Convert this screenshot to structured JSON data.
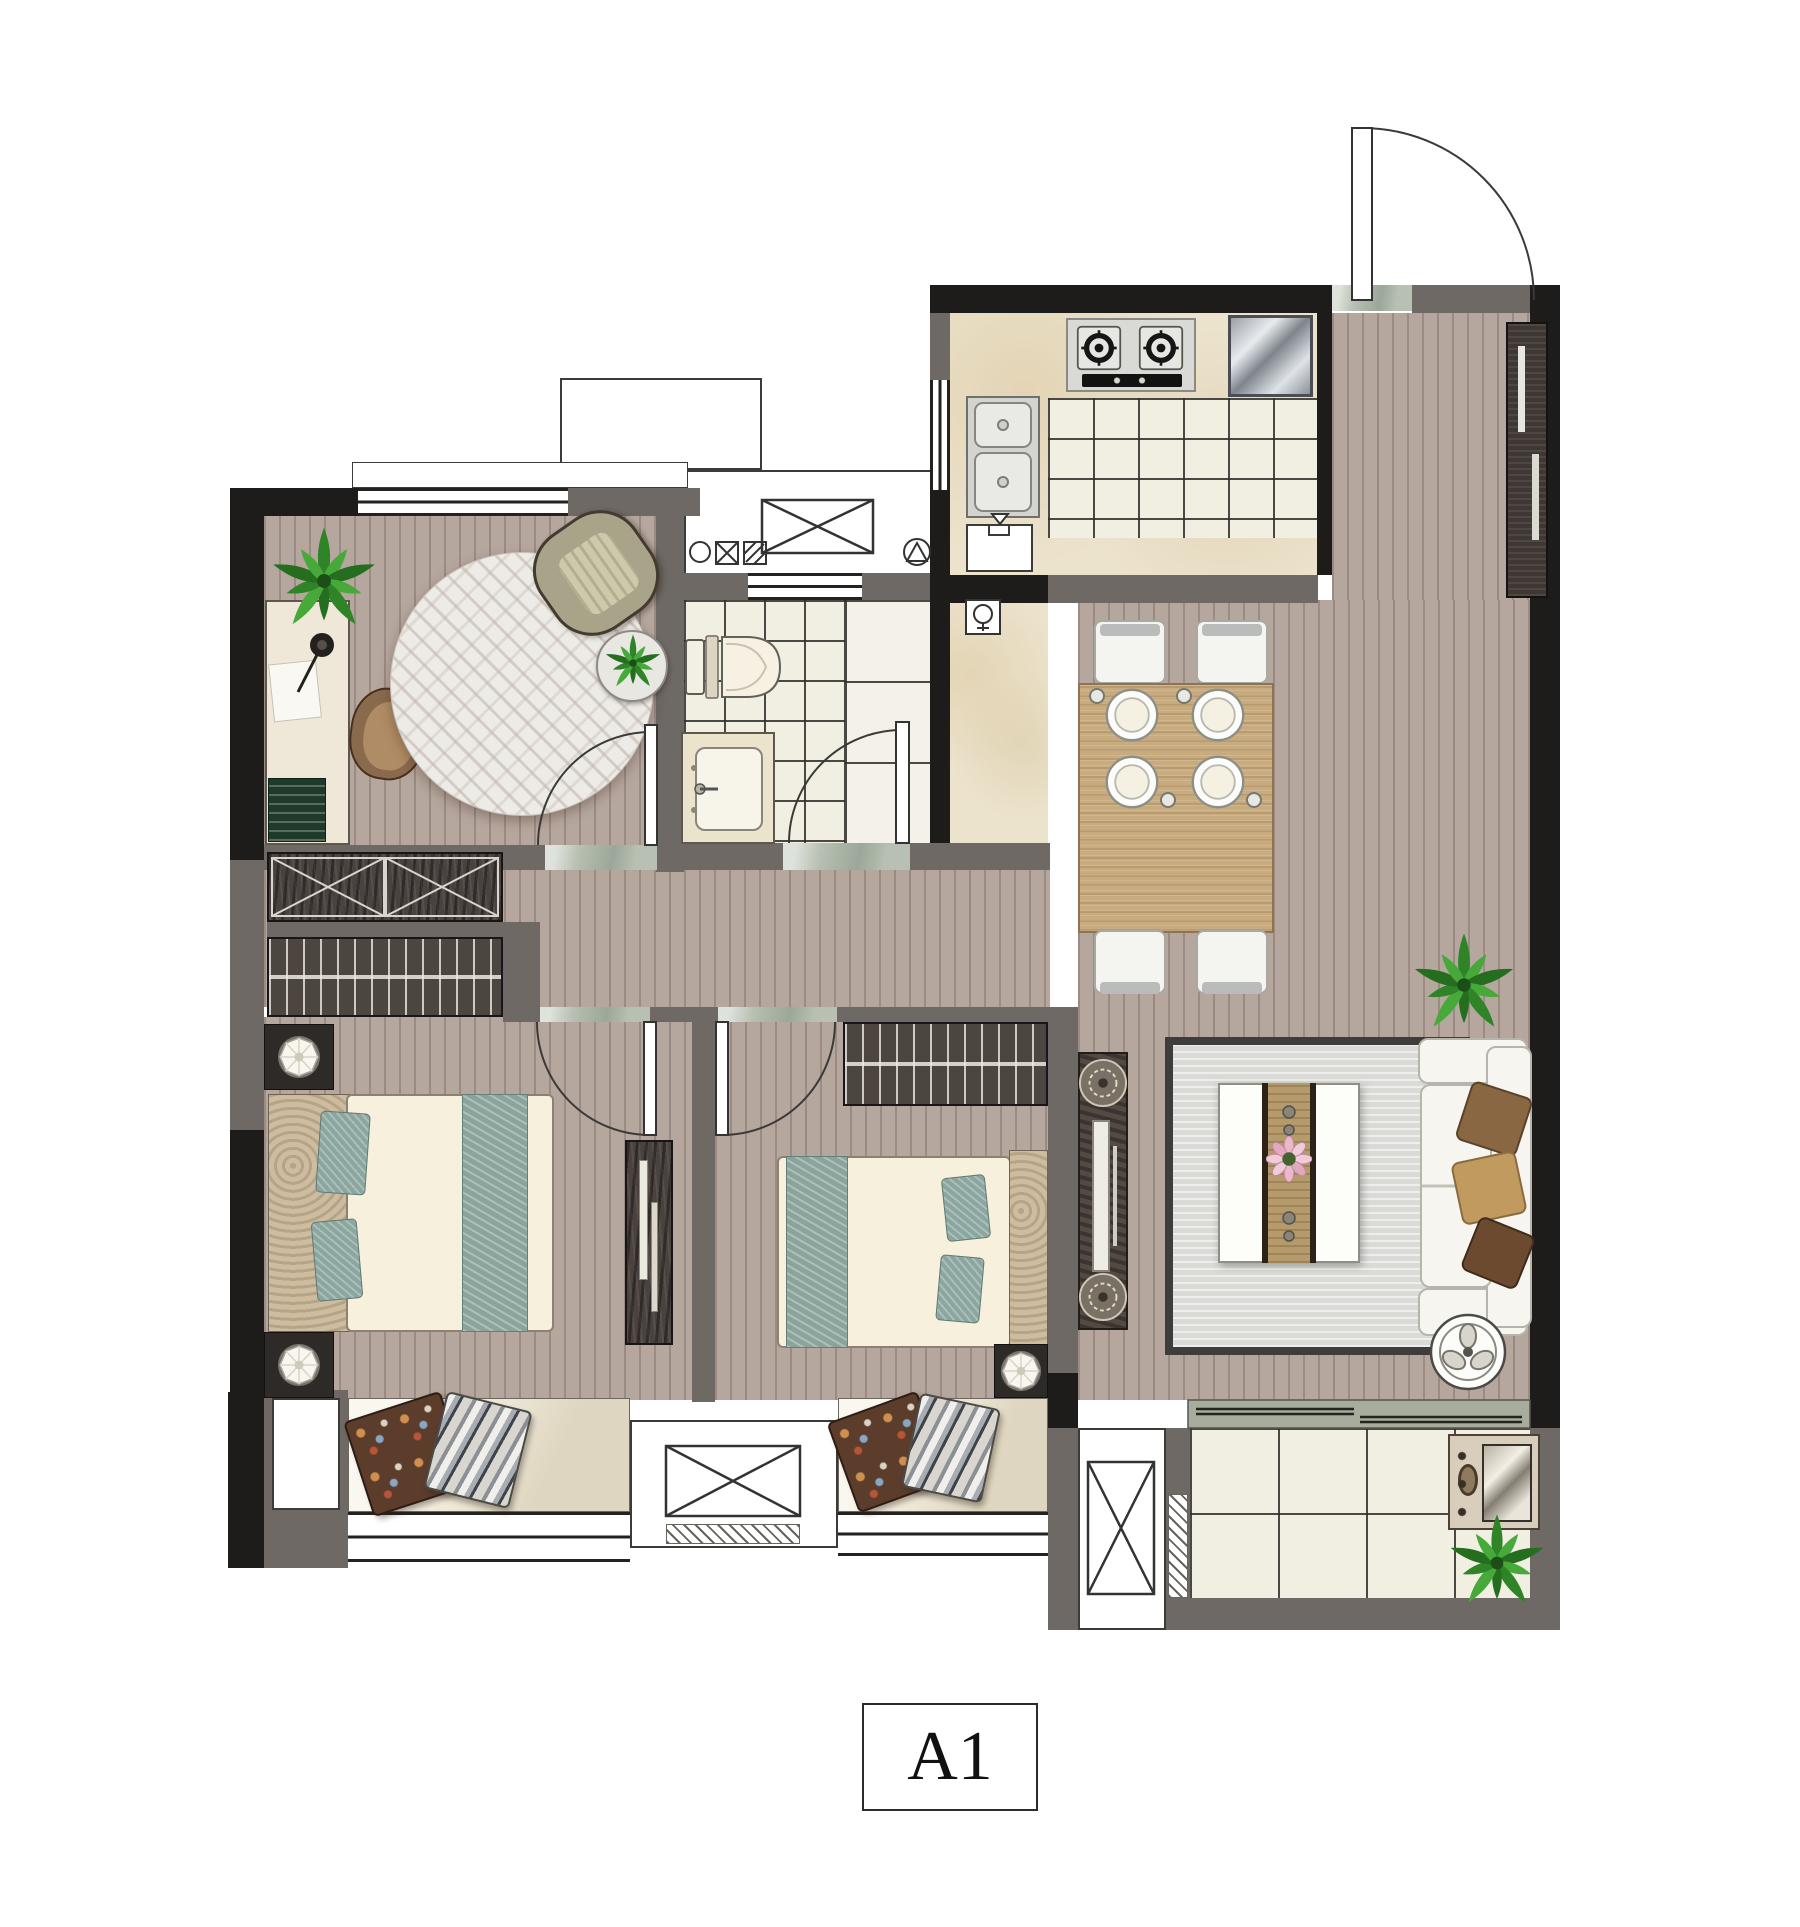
{
  "plan_label": {
    "text": "A1"
  },
  "palette": {
    "wall_structural": "#1d1c1a",
    "wall_partition": "#6e6965",
    "wood_floor": "#b6a79e",
    "tile_floor": "#f1eee2",
    "counter_marble": "#ece3cd",
    "threshold_marble": "#b7c0b2",
    "living_rug": "#dadbd7",
    "round_rug": "#edebe6",
    "bed_teal": "#8aa49c",
    "mattress": "#f6f0dd",
    "dark_wood_furniture": "#4a423e",
    "sofa_white": "#f6f5f0",
    "plant_green": "#2e8427",
    "dining_wood": "#c8ab7e"
  },
  "rooms": [
    {
      "id": "study",
      "furniture": [
        "potted-plant",
        "desk",
        "desk-lamp",
        "papers",
        "books",
        "desk-chair",
        "round-rug",
        "armchair",
        "plant-side-table"
      ]
    },
    {
      "id": "hallway",
      "furniture": [
        "storage-cabinet",
        "wardrobe"
      ]
    },
    {
      "id": "bathroom",
      "furniture": [
        "toilet",
        "vanity-sink",
        "duct-shaft",
        "vent-window",
        "floor-drain-symbols"
      ]
    },
    {
      "id": "kitchen",
      "furniture": [
        "gas-stove-2-burner",
        "dish-rack",
        "double-sink",
        "base-cabinet",
        "water-heater",
        "window"
      ]
    },
    {
      "id": "entry-foyer",
      "furniture": [
        "entry-door",
        "shoe-cabinet",
        "marble-threshold"
      ]
    },
    {
      "id": "dining-area",
      "furniture": [
        "dining-table",
        "dining-chair-x4",
        "place-setting-x4"
      ]
    },
    {
      "id": "living-room",
      "furniture": [
        "area-rug",
        "coffee-table",
        "flower-centerpiece",
        "sofa",
        "throw-pillow-x3",
        "tv-console",
        "decor-medallion-x2",
        "potted-plant",
        "round-tray"
      ]
    },
    {
      "id": "bedroom-1",
      "furniture": [
        "double-bed",
        "teal-runner",
        "teal-pillow-x2",
        "nightstand-x2",
        "table-lamp-x2",
        "dresser"
      ]
    },
    {
      "id": "bedroom-2",
      "furniture": [
        "double-bed",
        "teal-runner",
        "teal-pillow-x2",
        "wardrobe",
        "nightstand",
        "table-lamp"
      ]
    },
    {
      "id": "bay-window-1",
      "furniture": [
        "floral-cushion",
        "striped-cushion"
      ]
    },
    {
      "id": "bay-window-2",
      "furniture": [
        "floral-cushion",
        "striped-cushion"
      ]
    },
    {
      "id": "ac-platform",
      "furniture": [
        "equipment-cross-box"
      ]
    },
    {
      "id": "service-shaft-top",
      "furniture": [
        "duct-cross-box",
        "plumbing-symbols"
      ]
    },
    {
      "id": "service-shaft-bottom",
      "furniture": [
        "duct-cross-box"
      ]
    },
    {
      "id": "balcony",
      "furniture": [
        "sliding-door",
        "washing-machine",
        "potted-plant",
        "drain-hatch"
      ]
    }
  ],
  "doors": [
    "entry-door",
    "study-door",
    "bathroom-door",
    "bedroom-1-door",
    "bedroom-2-door"
  ]
}
